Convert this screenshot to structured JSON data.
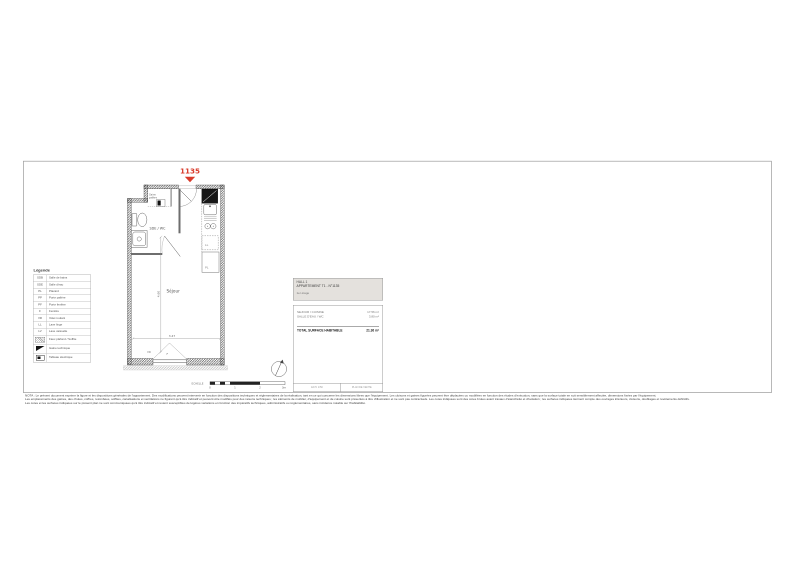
{
  "unit": {
    "number": "1135"
  },
  "plan": {
    "labels": {
      "bathroom": "SDE / WC",
      "living_room": "Séjour",
      "entry_duct_line1": "Gaine",
      "entry_duct_line2": "palière",
      "washing_machine": "LL",
      "closet": "PL",
      "shutter": "VR",
      "window": "F"
    },
    "dimensions": {
      "living_width": "3.47",
      "living_depth": "4.60"
    }
  },
  "legend": {
    "title": "Légende",
    "rows": [
      {
        "abbr": "SDB",
        "label": "Salle de bains"
      },
      {
        "abbr": "SDE",
        "label": "Salle d'eau"
      },
      {
        "abbr": "PL",
        "label": "Placard"
      },
      {
        "abbr": "PP",
        "label": "Porte palière"
      },
      {
        "abbr": "PF",
        "label": "Porte fenêtre"
      },
      {
        "abbr": "F",
        "label": "Fenêtre"
      },
      {
        "abbr": "VR",
        "label": "Volet roulant"
      },
      {
        "abbr": "LL",
        "label": "Lave linge"
      },
      {
        "abbr": "LV",
        "label": "Lave vaisselle"
      },
      {
        "abbr": "",
        "label": "Faux plafond / Soffite"
      },
      {
        "abbr": "",
        "label": "Gaine technique"
      },
      {
        "abbr": "",
        "label": "Tableau électrique"
      }
    ]
  },
  "info_panel": {
    "building": "HALL 1",
    "apartment": "APPARTEMENT T1 - N°1135",
    "floor": "1er étage",
    "surfaces": [
      {
        "name": "SEJOUR / CUISINE",
        "area": "17.56 m²"
      },
      {
        "name": "SALLE D'EAU / WC",
        "area": "3.80 m²"
      }
    ],
    "total_label": "TOTAL SURFACE HABITABLE",
    "total_area": "21.36 m²",
    "strip_left": "ECH. 1/50",
    "strip_right": "PLAN DE VENTE"
  },
  "scale_bar": {
    "label": "ECHELLE",
    "ticks": [
      "0",
      "1",
      "2",
      "3m"
    ]
  },
  "footer": {
    "lines": [
      "NOTA : Le présent document exprime la figure et les dispositions générales de l'appartement. Des modifications peuvent intervenir en fonction des dispositions techniques et réglementaires de la réalisation, tant en ce qui concerne les dimensions libres que l'équipement. Les cloisons et gaines figurées peuvent être déplacées ou modifiées en fonction des études d'exécution, sans que la surface totale en soit sensiblement affectée, dimensions fixées par l'équipement.",
      "Les emplacements des gaines, des chutes, coffres, retombées, soffites, canalisations et ventilations ne figurent qu'à titre indicatif et peuvent être modifiés pour des raisons techniques ; les éléments de mobilier, d'équipement et de cuisine sont présentés à titre d'illustration et ne sont pas contractuels. Les cotes indiquées sont des cotes brutes avant travaux d'étanchéité et d'isolation ; les surfaces indiquées tiennent compte des ouvrages intérieurs, cloisons, doublages et revêtements définitifs.",
      "Les cotes et les surfaces indiquées sur le présent plan ne sont communiquées qu'à titre indicatif et restent susceptibles de légères variations en fonction des impératifs techniques, administratifs ou réglementaires, sans incidence notable sur l'habitabilité."
    ]
  },
  "colors": {
    "accent_red": "#d93b2b",
    "wall": "#4a4a4a",
    "frame": "#9a9a9a"
  }
}
